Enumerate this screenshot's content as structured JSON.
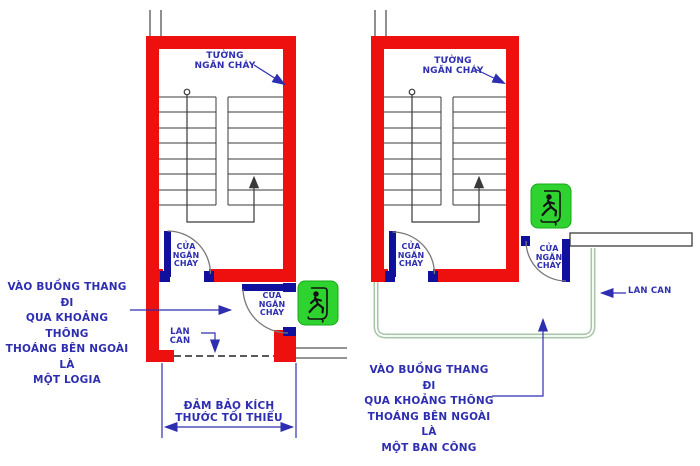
{
  "labels": {
    "fire_wall": [
      "TƯỜNG",
      "NGĂN CHÁY"
    ],
    "fire_door": [
      "CỬA",
      "NGĂN",
      "CHÁY"
    ],
    "railing": "LAN CAN",
    "dimension": [
      "ĐẢM BẢO KÍCH",
      "THƯỚC TỐI THIỂU"
    ],
    "left_caption": [
      "VÀO BUỒNG THANG ĐI",
      "QUA KHOẢNG THÔNG",
      "THOÁNG BÊN NGOÀI LÀ",
      "MỘT LOGIA"
    ],
    "right_caption": [
      "VÀO BUỒNG THANG ĐI",
      "QUA KHOẢNG THÔNG",
      "THOÁNG BÊN NGOÀI LÀ",
      "MỘT BAN CÔNG"
    ]
  },
  "colors": {
    "fire_wall_red": "#ee0f0f",
    "door_blue": "#10109c",
    "annotation_blue": "#2e2eb0",
    "exit_sign_green": "#2fd32f",
    "balcony_railing_green": "#a9c6a9",
    "line_dark": "#3a3a3a"
  }
}
